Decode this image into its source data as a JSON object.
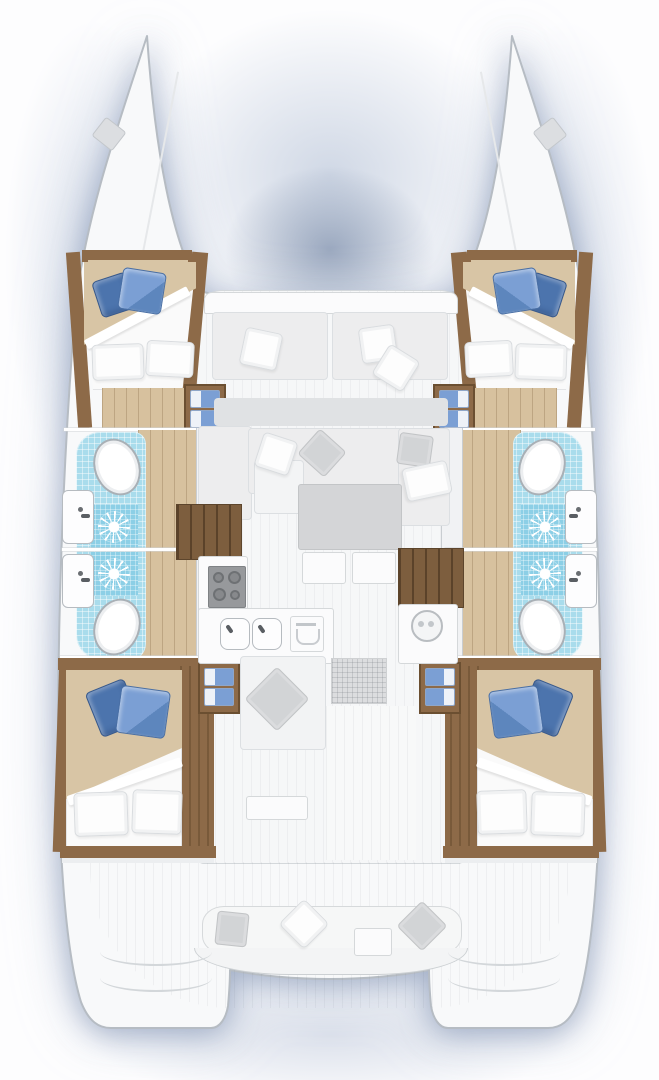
{
  "meta": {
    "domain": "Diagram",
    "subject": "catamaran-interior-floor-plan",
    "view": "top-down",
    "layout_version": "4-cabin 4-head charter layout"
  },
  "palette": {
    "hull": "#f8f9fa",
    "outline": "#b6bcc3",
    "deck": "#f6f7f8",
    "haze": "#b7c4d8",
    "wood_floor": "#d7c19e",
    "wood_trim": "#8d6a48",
    "wood_dark": "#6b4f31",
    "stair": "#7d5e3e",
    "tile": "#a9dcec",
    "tile_shower": "#8ccfe6",
    "bed_tan": "#d8c5a5",
    "bed_white": "#fafafa",
    "pillow_blue": "#7b9fd4",
    "pillow_blue_dark": "#4c74ad",
    "cushion": "#ededee",
    "pillow_gray": "#d2d4d6",
    "table_gray": "#d4d5d7",
    "stove": "#97999c",
    "mat": "#dcdddf"
  },
  "inventory": {
    "hulls": 2,
    "double_cabins": 4,
    "bathrooms": 4,
    "toilets": 4,
    "showers": 4,
    "washbasins": 4,
    "galley_burners": 4,
    "galley_sinks": 2,
    "salon_tables": 1,
    "salon_stools": 2,
    "companionway_stairs": 2,
    "cockpit_benches": 1,
    "bow_deck_hatches": 2,
    "blue_pillows": 8,
    "step_cushions": 8
  },
  "icons": [
    "shower-icon",
    "toilet-icon",
    "washbasin-icon",
    "stove-burners-icon",
    "double-sink-icon",
    "oven-icon",
    "washer-icon",
    "stairs-icon",
    "bow-hatch-icon",
    "pillow-icon"
  ]
}
